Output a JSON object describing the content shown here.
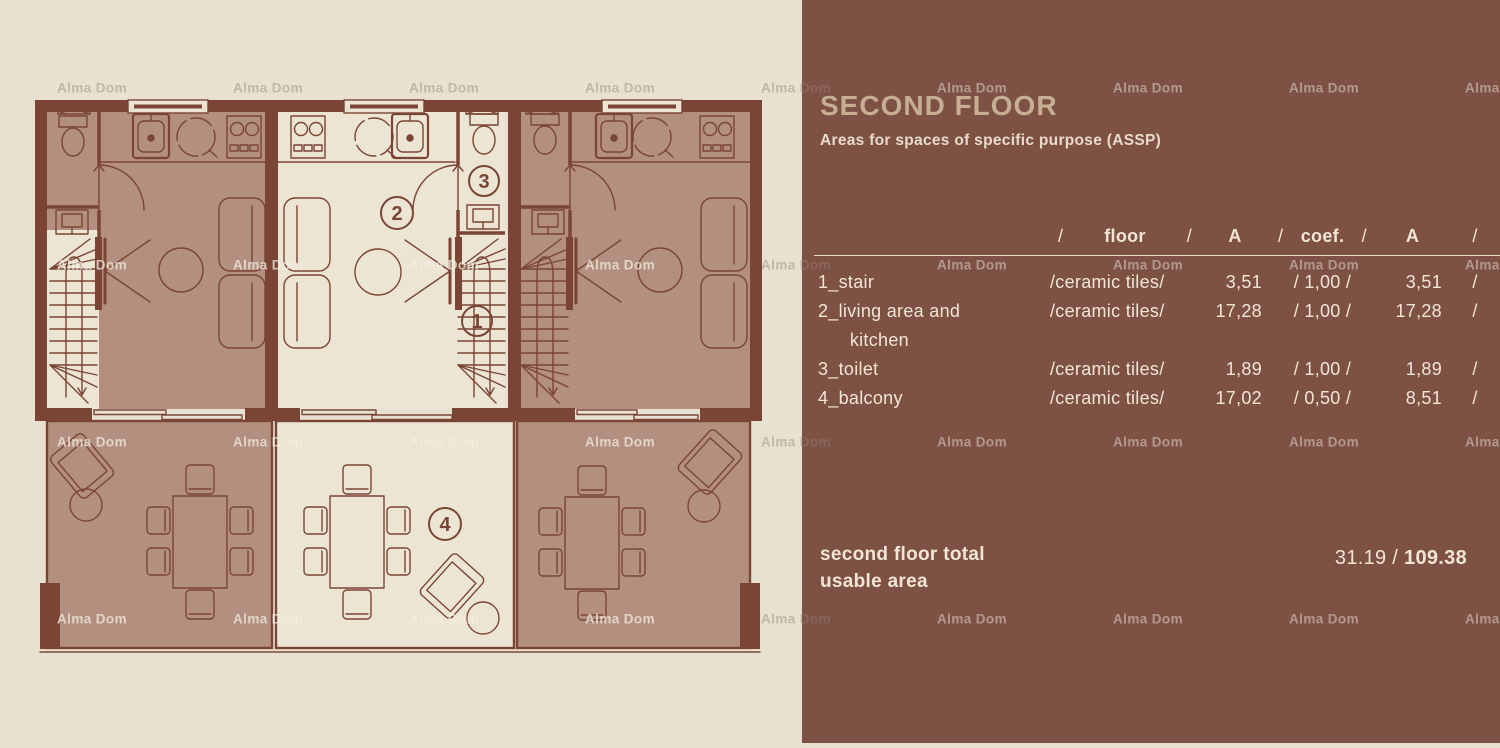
{
  "watermark": {
    "text": "Alma Dom"
  },
  "panel": {
    "title": "SECOND FLOOR",
    "subtitle": "Areas for spaces of specific purpose (ASSP)",
    "table": {
      "header": {
        "s1": "/",
        "floor": "floor",
        "s2": "/",
        "a": "A",
        "s3": "/",
        "coef": "coef.",
        "s4": "/",
        "a2": "A",
        "s5": "/"
      },
      "rows": [
        {
          "name": "1_stair",
          "floor": "/ceramic tiles/",
          "a": "3,51",
          "coef": "/ 1,00 /",
          "a2": "3,51",
          "end": "/"
        },
        {
          "name": "2_living area and\n      kitchen",
          "floor": "/ceramic tiles/",
          "a": "17,28",
          "coef": "/ 1,00 /",
          "a2": "17,28",
          "end": "/"
        },
        {
          "name": "3_toilet",
          "floor": "/ceramic tiles/",
          "a": "1,89",
          "coef": "/ 1,00 /",
          "a2": "1,89",
          "end": "/"
        },
        {
          "name": "4_balcony",
          "floor": "/ceramic tiles/",
          "a": "17,02",
          "coef": "/ 0,50 /",
          "a2": "8,51",
          "end": "/"
        }
      ]
    },
    "total": {
      "label": "second floor total\nusable area",
      "value_regular": "31.19 / ",
      "value_bold": "109.38"
    }
  },
  "plan": {
    "labels": {
      "stair": "1",
      "living_kitchen": "2",
      "toilet": "3",
      "balcony": "4"
    }
  },
  "colors": {
    "page_bg": "#e8e1d1",
    "panel_bg": "#7d5144",
    "wall": "#7b4535",
    "floor_dark": "#b28f7e",
    "floor_light": "#ece5d3",
    "title_text": "#c6ae92",
    "panel_text": "#f2e6d1"
  }
}
